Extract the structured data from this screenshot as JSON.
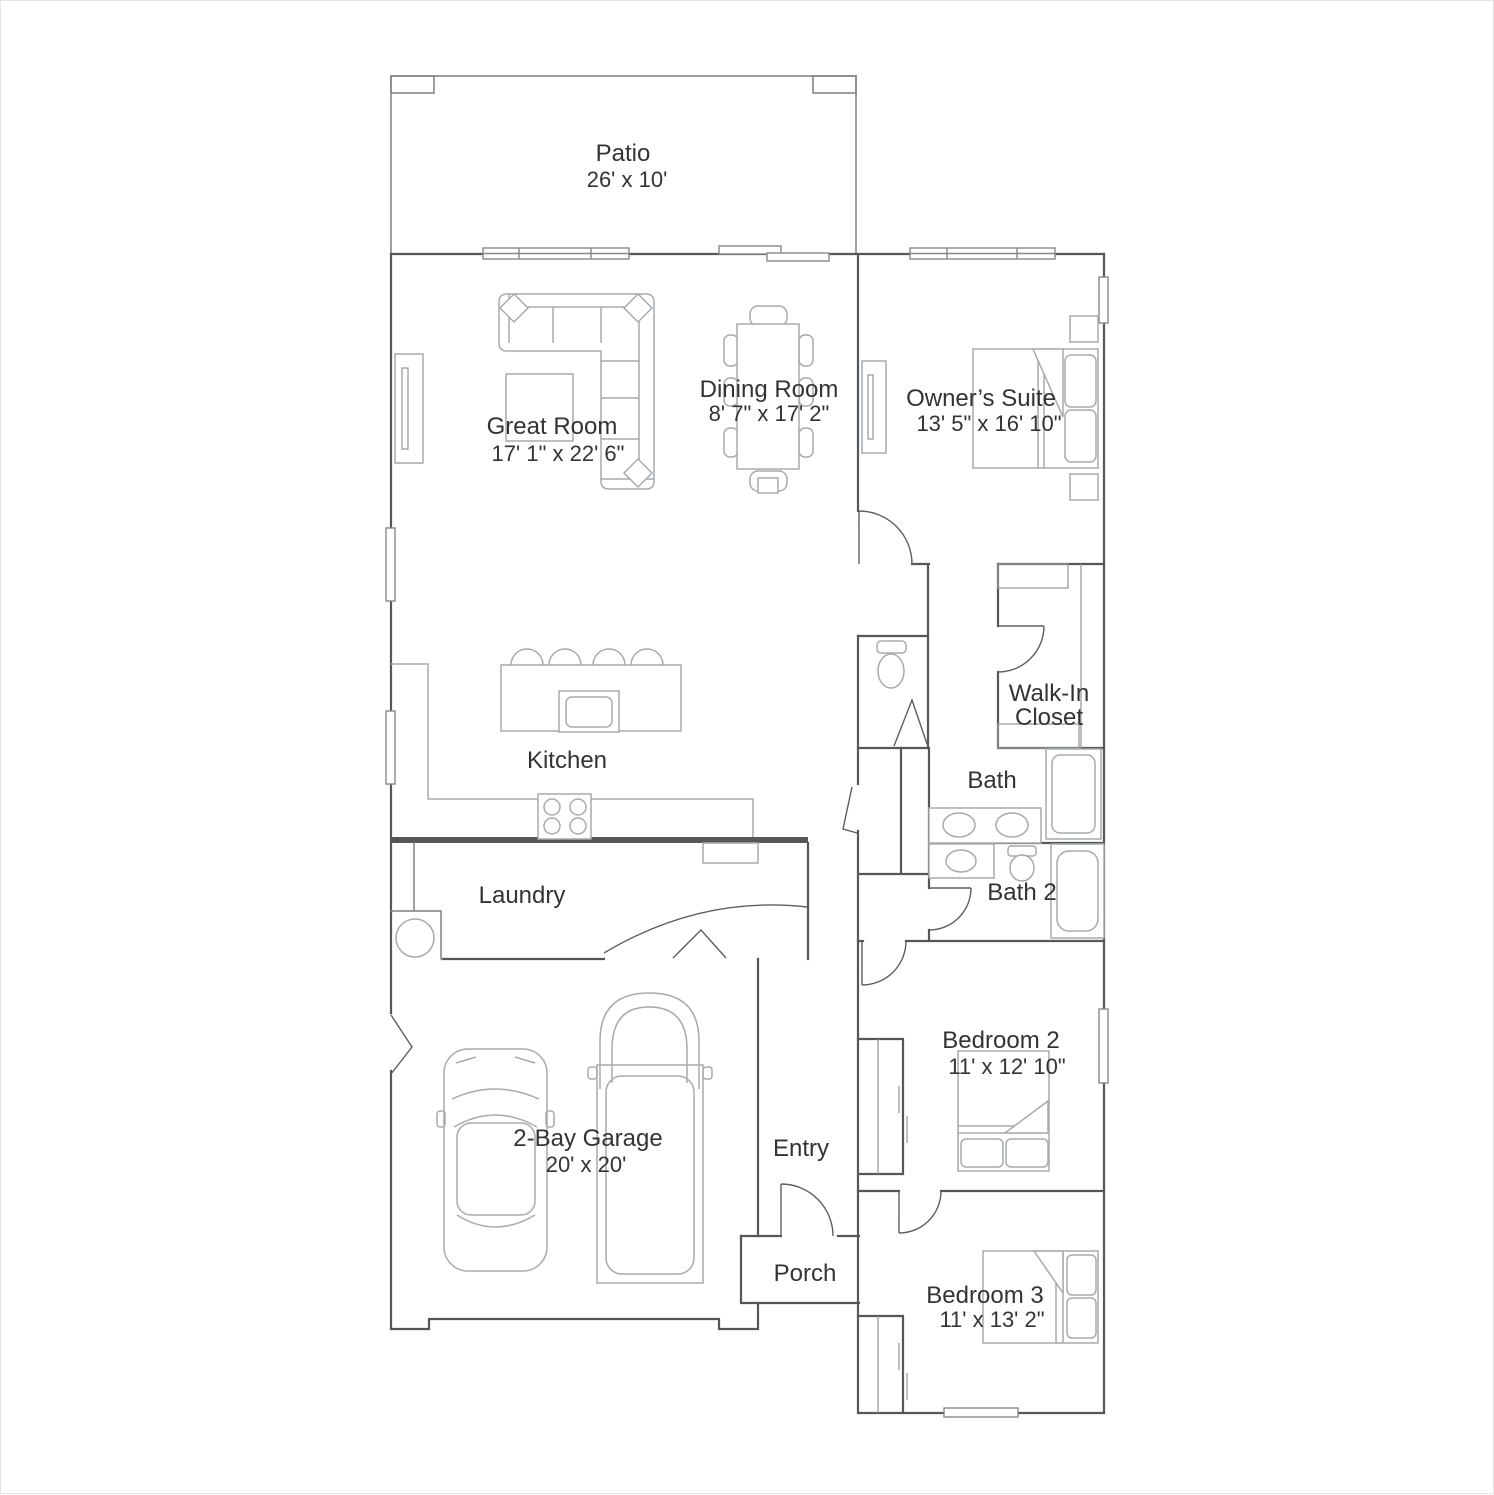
{
  "plan_title": "Single-story floor plan",
  "rooms": {
    "patio": {
      "name": "Patio",
      "dims": "26' x 10'"
    },
    "great_room": {
      "name": "Great Room",
      "dims": "17' 1\" x 22' 6\""
    },
    "dining_room": {
      "name": "Dining Room",
      "dims": "8' 7\" x 17' 2\""
    },
    "owners_suite": {
      "name": "Owner’s Suite",
      "dims": "13' 5\" x 16' 10\""
    },
    "walk_in_closet": {
      "name_line1": "Walk-In",
      "name_line2": "Closet"
    },
    "bath": {
      "name": "Bath"
    },
    "bath_2": {
      "name": "Bath 2"
    },
    "kitchen": {
      "name": "Kitchen"
    },
    "laundry": {
      "name": "Laundry"
    },
    "garage": {
      "name": "2-Bay Garage",
      "dims": "20' x 20'"
    },
    "entry": {
      "name": "Entry"
    },
    "porch": {
      "name": "Porch"
    },
    "bedroom_2": {
      "name": "Bedroom 2",
      "dims": "11' x 12' 10\""
    },
    "bedroom_3": {
      "name": "Bedroom 3",
      "dims": "11' x 13' 2\""
    }
  },
  "colors": {
    "wall": "#55585b",
    "furniture": "#a7abad",
    "text": "#333333",
    "background": "#ffffff"
  }
}
